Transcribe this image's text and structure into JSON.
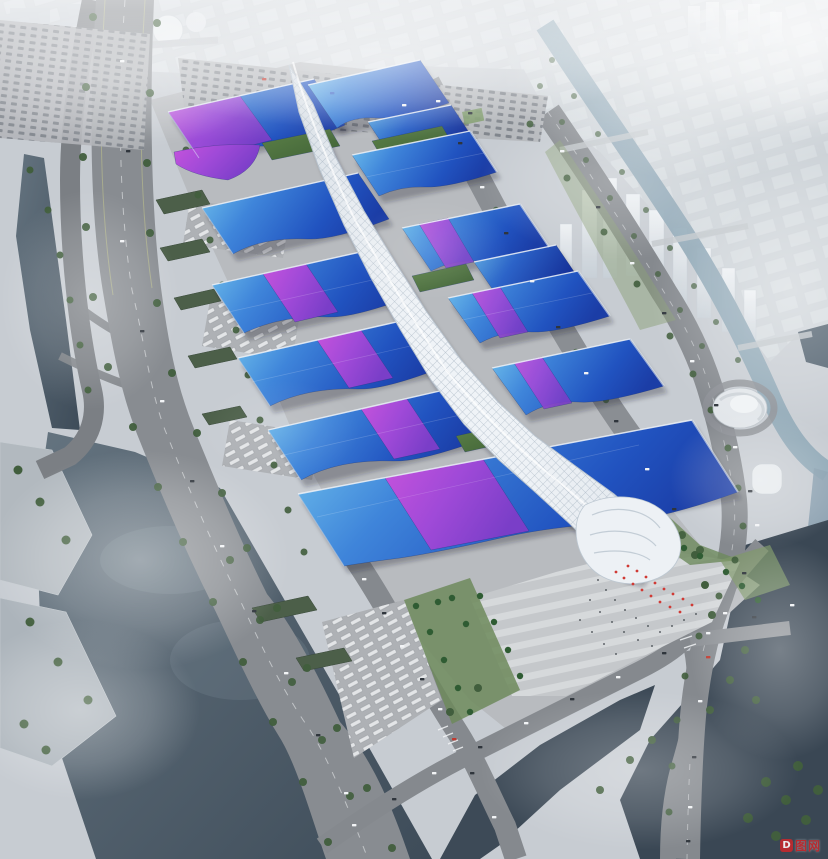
{
  "scene": {
    "type": "aerial architectural rendering",
    "subject": "riverside exhibition and convention center complex",
    "atmosphere": "hazy daylight, mist over rivers and distant white city blocks",
    "landmark_features": [
      "serpentine white lattice concourse spine running the length of the complex",
      "wave-edged exhibition hall roofs in gradient blue with purple-magenta ribbons",
      "south entrance glass canopy with striped arrival plaza and palm trees",
      "tree-lined boulevard bridging a wide misty river on the west",
      "canal with bridges and hazy towers on the east",
      "green-roof service sheds, bus lots and large car parks"
    ],
    "halls_visible": 13
  },
  "palette": {
    "roof_blue_light": "#74c6ee",
    "roof_blue_deep": "#1b3da6",
    "roof_purple": "#a04ad8",
    "roof_magenta": "#c653dc",
    "spine_white": "#eff3f7",
    "river_dark": "#3e4c59",
    "canal": "#8ea6b5",
    "road_gray": "#85898e",
    "pavement": "#b8bbbf",
    "tree_green": "#415e3d",
    "city_haze": "#d3d8dd",
    "watermark_red": "#c4282d"
  },
  "watermark": {
    "logo_letter": "D",
    "text": "图网"
  }
}
